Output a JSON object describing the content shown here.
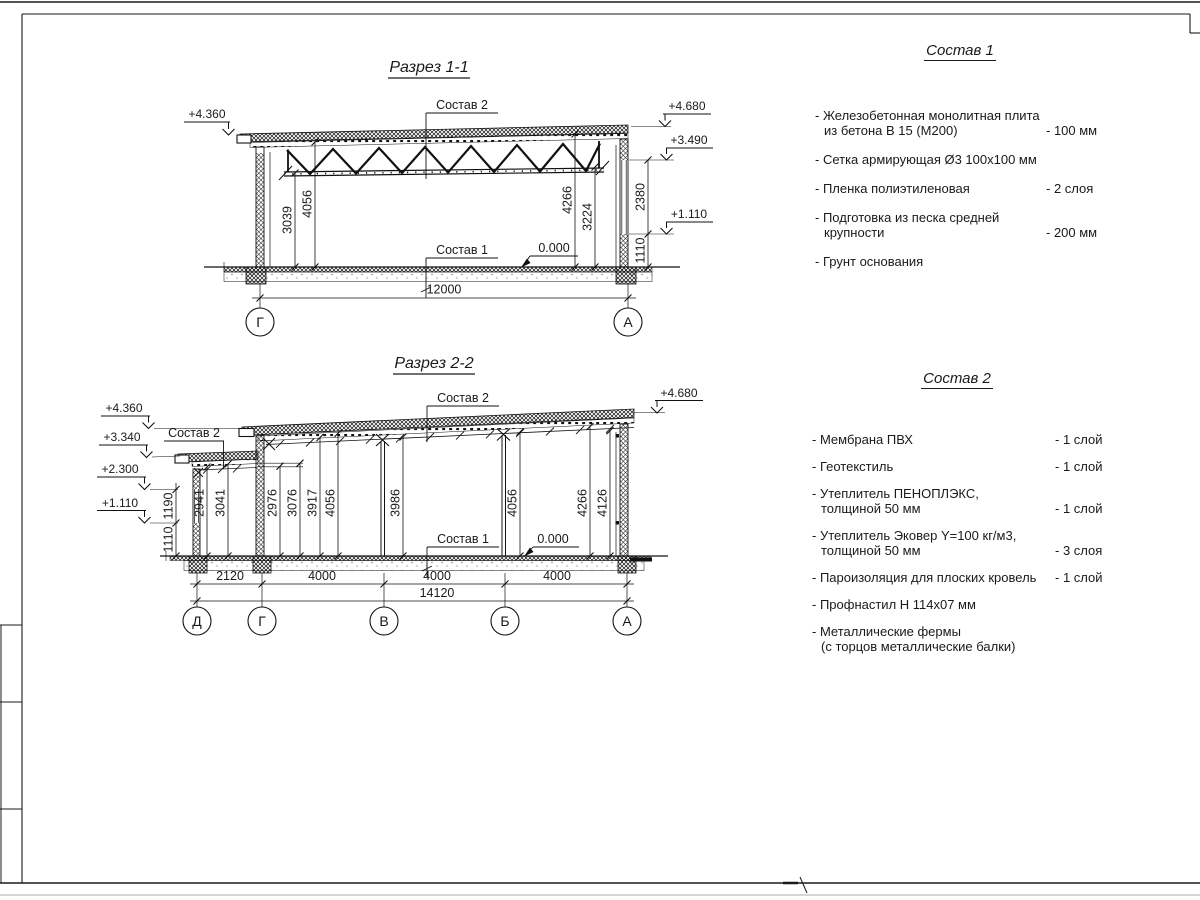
{
  "sections": {
    "s1": {
      "title": "Разрез 1-1",
      "label_sostav2": "Состав 2",
      "label_sostav1": "Состав 1",
      "zero": "0.000",
      "elev_left": "+4.360",
      "elev_r1": "+4.680",
      "elev_r2": "+3.490",
      "elev_r3": "+1.110",
      "dim_v1": "3039",
      "dim_v2": "4056",
      "dim_v3": "4266",
      "dim_v4": "3224",
      "dim_side1": "2380",
      "dim_side2": "1110",
      "dim_total": "12000",
      "axis_l": "Г",
      "axis_r": "А"
    },
    "s2": {
      "title": "Разрез 2-2",
      "label_sostav2_a": "Состав 2",
      "label_sostav2_b": "Состав 2",
      "label_sostav1": "Состав 1",
      "zero": "0.000",
      "elev_l1": "+4.360",
      "elev_l2": "+3.340",
      "elev_l3": "+2.300",
      "elev_l4": "+1.110",
      "elev_r1": "+4.680",
      "dim_left1": "1190",
      "dim_left2": "1110",
      "dim_v1": "2941",
      "dim_v2": "3041",
      "dim_v3": "2976",
      "dim_v4": "3076",
      "dim_v5": "3917",
      "dim_v6": "4056",
      "dim_v7": "3986",
      "dim_v8": "4056",
      "dim_v9": "4266",
      "dim_v10": "4126",
      "dim_b1": "2120",
      "dim_b2": "4000",
      "dim_b3": "4000",
      "dim_b4": "4000",
      "dim_total": "14120",
      "axis_1": "Д",
      "axis_2": "Г",
      "axis_3": "В",
      "axis_4": "Б",
      "axis_5": "А"
    }
  },
  "sostav1": {
    "title": "Состав 1",
    "items": [
      {
        "line1": "- Железобетонная  монолитная плита",
        "line2": "из бетона В 15 (М200)",
        "value": "- 100 мм"
      },
      {
        "line1": "- Сетка армирующая Ø3 100х100 мм",
        "line2": "",
        "value": ""
      },
      {
        "line1": "- Пленка полиэтиленовая",
        "line2": "",
        "value": "-  2 слоя"
      },
      {
        "line1": "- Подготовка из песка средней",
        "line2": "крупности",
        "value": "- 200 мм"
      },
      {
        "line1": "- Грунт основания",
        "line2": "",
        "value": ""
      }
    ]
  },
  "sostav2": {
    "title": "Состав 2",
    "items": [
      {
        "line1": "- Мембрана ПВХ",
        "line2": "",
        "value": "- 1 слой"
      },
      {
        "line1": "- Геотекстиль",
        "line2": "",
        "value": "- 1 слой"
      },
      {
        "line1": "- Утеплитель ПЕНОПЛЭКС,",
        "line2": "толщиной 50 мм",
        "value": "- 1 слой"
      },
      {
        "line1": "- Утеплитель Эковер Y=100 кг/м3,",
        "line2": "толщиной 50 мм",
        "value": "- 3 слоя"
      },
      {
        "line1": "- Пароизоляция для плоских кровель",
        "line2": "",
        "value": "- 1 слой"
      },
      {
        "line1": "- Профнастил Н 114х07 мм",
        "line2": "",
        "value": ""
      },
      {
        "line1": "- Металлические фермы",
        "line2": "(с торцов металлические балки)",
        "value": ""
      }
    ]
  }
}
